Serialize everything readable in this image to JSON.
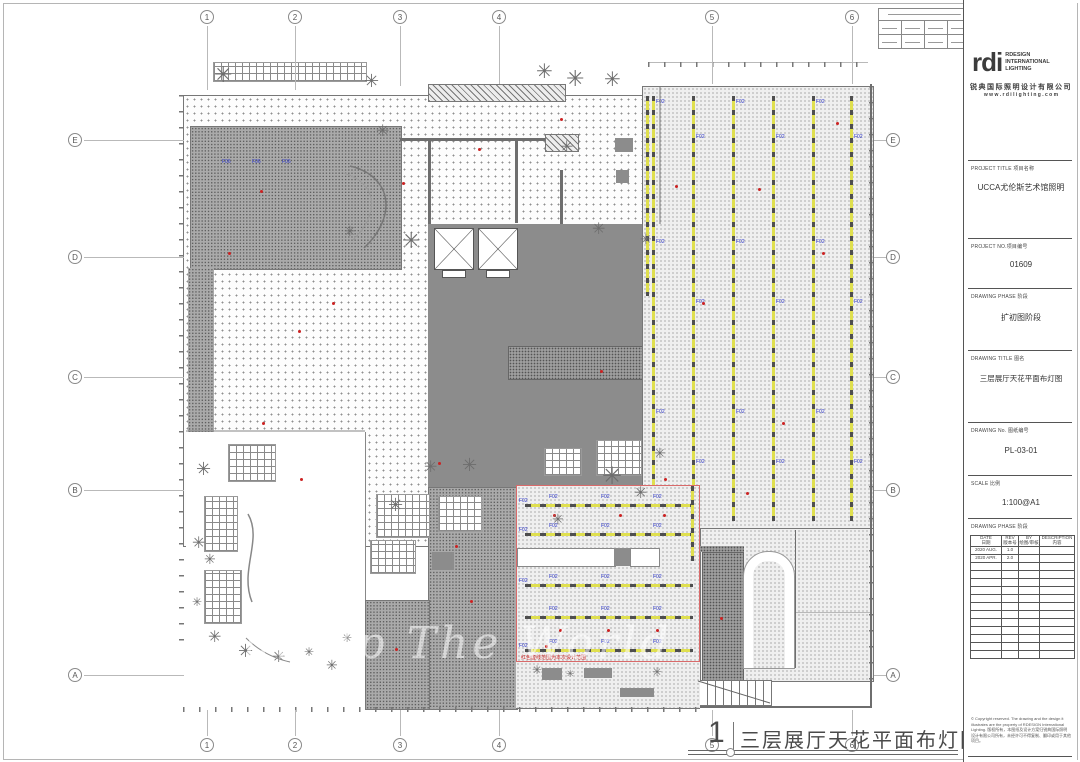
{
  "icons": {
    "tree": "✳"
  },
  "grid": {
    "cols": [
      "1",
      "2",
      "3",
      "4",
      "5",
      "6"
    ],
    "rows": [
      "E",
      "D",
      "C",
      "B",
      "A"
    ]
  },
  "caption": {
    "number": "1",
    "text": "三层展厅天花平面布灯图1：100"
  },
  "watermark": "Light Up The World",
  "plan": {
    "track_lamp_code": "F02",
    "lobby_lamp_code": "F06",
    "red_zone_note": "红色虚线范围为本次设计范围"
  },
  "title_block": {
    "logo": {
      "brand": "rdi",
      "lines": [
        "RDESIGN",
        "INTERNATIONAL",
        "LIGHTING"
      ],
      "company": "锐典国际照明设计有限公司",
      "website": "w w w . r d i l i g h t i n g . c o m"
    },
    "project_title_label": "PROJECT TITLE 项目名称",
    "project_title": "UCCA尤伦斯艺术馆照明",
    "project_no_label": "PROJECT NO.项目编号",
    "project_no": "01609",
    "phase_label": "DRAWING PHASE 阶段",
    "phase": "扩初图阶段",
    "drawing_title_label": "DRAWING TITLE 图名",
    "drawing_title": "三层展厅天花平面布灯图",
    "drawing_no_label": "DRAWING No. 图纸编号",
    "drawing_no": "PL-03-01",
    "scale_label": "SCALE 比例",
    "scale": "1:100@A1",
    "rev_label": "DRAWING PHASE 阶段",
    "rev_headers": [
      [
        "DATE",
        "日期"
      ],
      [
        "REV",
        "版本号"
      ],
      [
        "BY",
        "绘图/审核"
      ],
      [
        "DESCRIPTION",
        "内容"
      ]
    ],
    "rev_rows": [
      [
        "2020 AUG.",
        "1.0"
      ],
      [
        "2020 APR.",
        "2.0"
      ]
    ],
    "copyright": "© Copyright reserved. The drawing and the design it illustrates are the property of RDESIGN International Lighting. 版权所有，本图纸及设计方案归锐典国际照明设计有限公司所有，未经许可不得复制、翻印或用于其他项目。"
  }
}
